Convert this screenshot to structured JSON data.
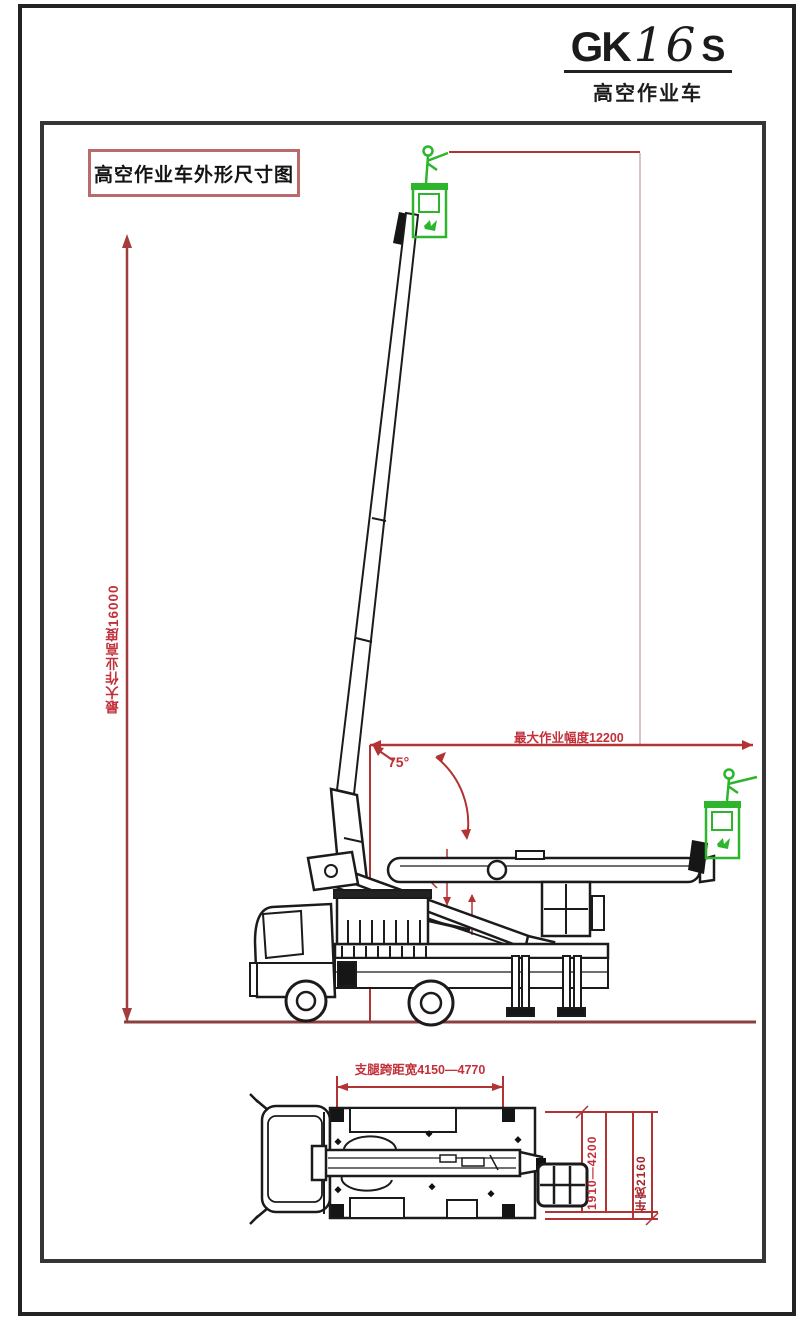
{
  "title": {
    "model_prefix": "GK",
    "model_number": "16",
    "model_suffix": "S",
    "subtitle": "高空作业车"
  },
  "frame": {
    "drawing_label": "高空作业车外形尺寸图"
  },
  "dimensions": {
    "max_working_height": "最大作业高度16000",
    "max_working_radius": "最大作业幅度12200",
    "boom_angle": "75°",
    "outrigger_span": "支腿跨距宽4150—4770",
    "outrigger_width_range": "1910—4200",
    "vehicle_width": "车宽2160"
  },
  "colors": {
    "dimension_red": "#b23333",
    "label_red": "#c2303a",
    "ground_red": "#8b4040",
    "basket_green": "#2db52d",
    "line_black": "#1b1b1b"
  }
}
